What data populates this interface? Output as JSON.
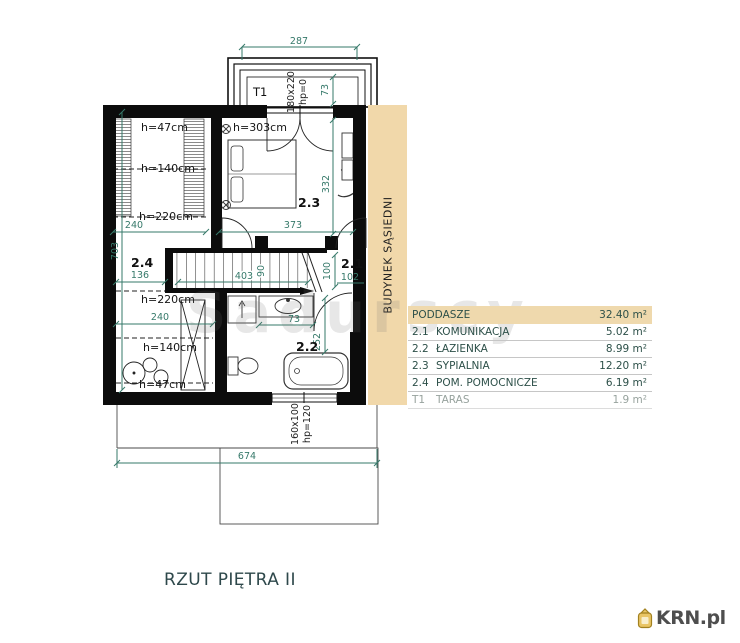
{
  "title": "RZUT PIĘTRA II",
  "watermark": "Sadurscy",
  "brand": {
    "name": "KRN.pl"
  },
  "neighbor": {
    "label": "BUDYNEK SĄSIEDNI"
  },
  "legend": {
    "header": {
      "name": "PODDASZE",
      "area": "32.40 m²"
    },
    "rows": [
      {
        "id": "2.1",
        "name": "KOMUNIKACJA",
        "area": "5.02 m²"
      },
      {
        "id": "2.2",
        "name": "ŁAZIENKA",
        "area": "8.99 m²"
      },
      {
        "id": "2.3",
        "name": "SYPIALNIA",
        "area": "12.20 m²"
      },
      {
        "id": "2.4",
        "name": "POM. POMOCNICZE",
        "area": "6.19 m²"
      },
      {
        "id": "T1",
        "name": "TARAS",
        "area": "1.9 m²"
      }
    ]
  },
  "plan": {
    "terrace": {
      "label": "T1",
      "width": "287",
      "depth": "73",
      "door_size": "180x220",
      "door_sill": "hp=0"
    },
    "bedroom": {
      "label": "2.3",
      "ceiling": "h=303cm",
      "width": "373",
      "depth": "332"
    },
    "corridor": {
      "label": "2.1",
      "width": "100",
      "width2": "102"
    },
    "bathroom": {
      "label": "2.2",
      "counter": "73",
      "depth": "252"
    },
    "utility": {
      "label": "2.4",
      "landing": "136",
      "width": "240",
      "heights": [
        "h=220cm",
        "h=140cm",
        "h=47cm"
      ]
    },
    "attic": {
      "width": "240",
      "heights": [
        "h=47cm",
        "h=140cm",
        "h=220cm"
      ]
    },
    "stairs": {
      "length": "403",
      "width": "90"
    },
    "left_depth": "703",
    "total_width": "674",
    "bottom_window": {
      "size": "160x100",
      "sill": "hp=120"
    }
  },
  "colors": {
    "dimension_teal": "#36796a",
    "neighbor_beige": "#f1d8aa",
    "wall": "#0c0c0c",
    "header_beige": "#efd9ad",
    "brand_gold": "#e9c565"
  }
}
